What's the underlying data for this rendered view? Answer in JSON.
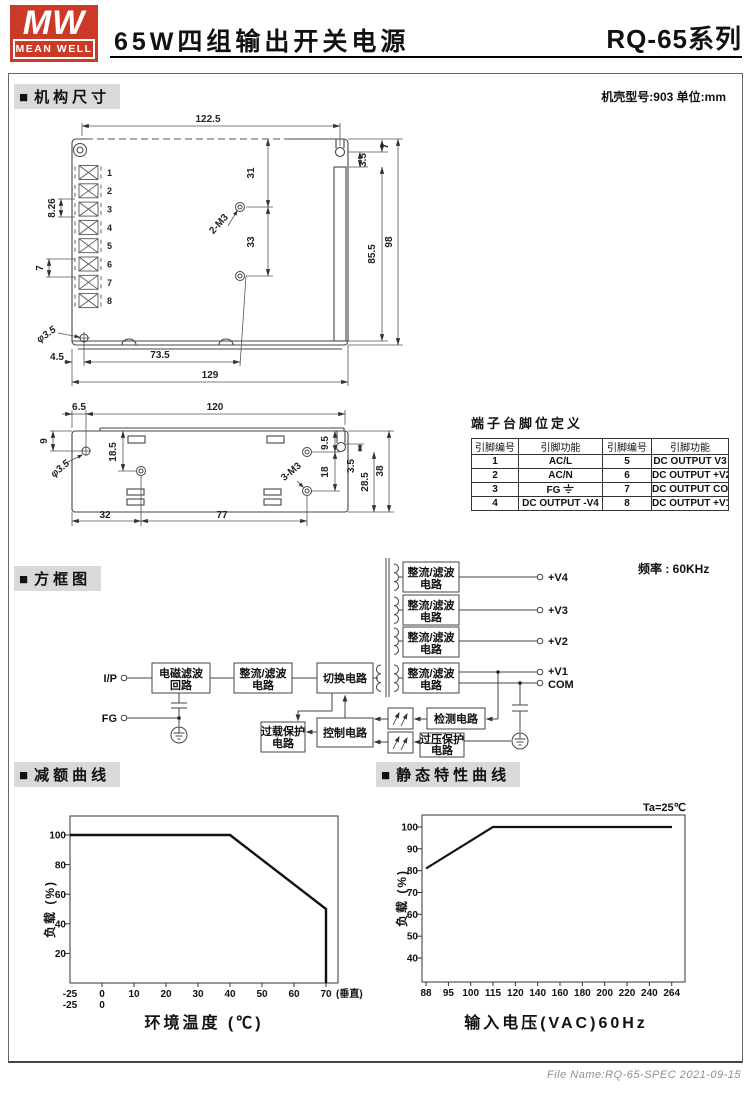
{
  "header": {
    "logo_mw": "MW",
    "logo_brand": "MEAN WELL",
    "title": "65W四组输出开关电源",
    "series": "RQ-65系列"
  },
  "sections": {
    "bullet": "■",
    "mech": "机构尺寸",
    "block": "方框图",
    "derating": "减额曲线",
    "static": "静态特性曲线"
  },
  "mech": {
    "case_note": "机壳型号:903 单位:mm",
    "top_view": {
      "w122": "122.5",
      "h31": "31",
      "h33": "33",
      "m3": "2-M3",
      "h855": "85.5",
      "h98": "98",
      "n35": "3.5",
      "n7": "7",
      "pitch": "8.26",
      "pitch7": "7",
      "dia": "φ3.5",
      "off45": "4.5",
      "w735": "73.5",
      "w129": "129",
      "pins": [
        "1",
        "2",
        "3",
        "4",
        "5",
        "6",
        "7",
        "8"
      ]
    },
    "side_view": {
      "off65": "6.5",
      "w120": "120",
      "h9": "9",
      "h185": "18.5",
      "dia": "φ3.5",
      "h95": "9.5",
      "h18": "18",
      "n35": "3.5",
      "h285": "28.5",
      "h38": "38",
      "m3": "3-M3",
      "w32": "32",
      "w77": "77"
    },
    "pin_table": {
      "title": "端子台脚位定义",
      "headers": [
        "引脚编号",
        "引脚功能",
        "引脚编号",
        "引脚功能"
      ],
      "rows": [
        [
          "1",
          "AC/L",
          "5",
          "DC OUTPUT V3"
        ],
        [
          "2",
          "AC/N",
          "6",
          "DC OUTPUT +V2"
        ],
        [
          "3",
          "FG",
          "7",
          "DC OUTPUT COM"
        ],
        [
          "4",
          "DC OUTPUT -V4",
          "8",
          "DC OUTPUT +V1"
        ]
      ]
    }
  },
  "block": {
    "freq_note": "频率 : 60KHz",
    "ip": "I/P",
    "fg": "FG",
    "emi_l1": "电磁滤波",
    "emi_l2": "回路",
    "rect_l1": "整流/滤波",
    "rect_l2": "电路",
    "switch": "切换电路",
    "detect": "检测电路",
    "ovp_l1": "过压保护",
    "ovp_l2": "电路",
    "control": "控制电路",
    "olp_l1": "过载保护",
    "olp_l2": "电路",
    "out_v4": "+V4",
    "out_v3": "+V3",
    "out_v2": "+V2",
    "out_v1": "+V1",
    "out_com": "COM"
  },
  "chart_data": [
    {
      "type": "line",
      "title": "减额曲线",
      "xlabel": "环境温度 (℃)",
      "ylabel": "负载 (%)",
      "xticks": [
        "-25",
        "0",
        "10",
        "20",
        "30",
        "40",
        "50",
        "60",
        "70"
      ],
      "xticks_row2": [
        "-25",
        "0"
      ],
      "x_note": "(垂直)",
      "yticks": [
        "20",
        "40",
        "60",
        "80",
        "100"
      ],
      "ylim": [
        0,
        110
      ],
      "points": [
        [
          -25,
          100
        ],
        [
          40,
          100
        ],
        [
          70,
          50
        ],
        [
          70,
          0
        ]
      ],
      "grid": false,
      "legend": "none"
    },
    {
      "type": "line",
      "title": "静态特性曲线",
      "annotation": "Ta=25℃",
      "xlabel": "输入电压(VAC)60Hz",
      "ylabel": "负载 (%)",
      "xticks": [
        "88",
        "95",
        "100",
        "115",
        "120",
        "140",
        "160",
        "180",
        "200",
        "220",
        "240",
        "264"
      ],
      "yticks": [
        "40",
        "50",
        "60",
        "70",
        "80",
        "90",
        "100"
      ],
      "ylim": [
        30,
        105
      ],
      "points": [
        [
          88,
          81
        ],
        [
          115,
          100
        ],
        [
          264,
          100
        ]
      ],
      "grid": false,
      "legend": "none"
    }
  ],
  "footer": {
    "file_note": "File Name:RQ-65-SPEC  2021-09-15"
  },
  "colors": {
    "brand_red": "#cb3a27",
    "section_bg": "#d9d9d9",
    "line": "#444444",
    "footer_gray": "#8f8f8f"
  }
}
